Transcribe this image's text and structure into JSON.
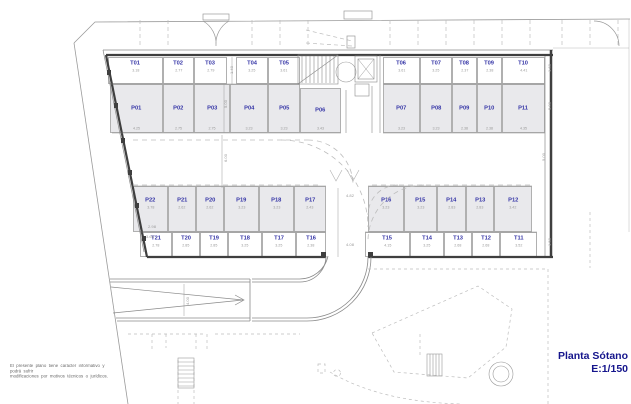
{
  "title": {
    "name": "Planta Sótano",
    "scale": "E:1/150"
  },
  "disclaimer": {
    "line1": "El presente plano tiene carácter informativo y podrá sufrir",
    "line2": "modificaciones por motivos técnicos o jurídicos."
  },
  "rows": {
    "top_trasteros_left": [
      {
        "id": "T01",
        "dim": "3.18"
      },
      {
        "id": "T02",
        "dim": "2.77"
      },
      {
        "id": "T03",
        "dim": "2.79"
      },
      {
        "id": "T04",
        "dim": "3.25"
      },
      {
        "id": "T05",
        "dim": "3.61"
      }
    ],
    "top_trasteros_right": [
      {
        "id": "T06",
        "dim": "3.61"
      },
      {
        "id": "T07",
        "dim": "3.25"
      },
      {
        "id": "T08",
        "dim": "2.37"
      },
      {
        "id": "T09",
        "dim": "2.38"
      },
      {
        "id": "T10",
        "dim": "4.41"
      }
    ],
    "top_parkings_left": [
      {
        "id": "P01",
        "dim": "4.25"
      },
      {
        "id": "P02",
        "dim": "2.75"
      },
      {
        "id": "P03",
        "dim": "2.75"
      },
      {
        "id": "P04",
        "dim": "3.23"
      },
      {
        "id": "P05",
        "dim": "3.23"
      }
    ],
    "center_parking": [
      {
        "id": "P06",
        "dim": "3.43"
      }
    ],
    "top_parkings_right": [
      {
        "id": "P07",
        "dim": "3.23"
      },
      {
        "id": "P08",
        "dim": "3.23"
      },
      {
        "id": "P09",
        "dim": "2.38"
      },
      {
        "id": "P10",
        "dim": "2.38"
      },
      {
        "id": "P11",
        "dim": "4.35"
      }
    ],
    "mid_parkings_left": [
      {
        "id": "P22",
        "dim": "3.78"
      },
      {
        "id": "P21",
        "dim": "2.62"
      },
      {
        "id": "P20",
        "dim": "2.62"
      },
      {
        "id": "P19",
        "dim": "3.23"
      },
      {
        "id": "P18",
        "dim": "3.23"
      },
      {
        "id": "P17",
        "dim": "2.43"
      }
    ],
    "mid_parkings_right": [
      {
        "id": "P16",
        "dim": "3.23"
      },
      {
        "id": "P15",
        "dim": "3.23"
      },
      {
        "id": "P14",
        "dim": "2.83"
      },
      {
        "id": "P13",
        "dim": "2.83"
      },
      {
        "id": "P12",
        "dim": "3.42"
      }
    ],
    "bottom_trasteros_left": [
      {
        "id": "T21",
        "dim": "2.78"
      },
      {
        "id": "T20",
        "dim": "2.85"
      },
      {
        "id": "T19",
        "dim": "2.85"
      },
      {
        "id": "T18",
        "dim": "3.25"
      },
      {
        "id": "T17",
        "dim": "3.25"
      },
      {
        "id": "T16",
        "dim": "2.38"
      }
    ],
    "bottom_trasteros_right": [
      {
        "id": "T15",
        "dim": "4.15"
      },
      {
        "id": "T14",
        "dim": "3.25"
      },
      {
        "id": "T13",
        "dim": "2.68"
      },
      {
        "id": "T12",
        "dim": "2.68"
      },
      {
        "id": "T11",
        "dim": "3.52"
      }
    ]
  },
  "dims": {
    "stall_depth": "5.00",
    "aisle_width": "6.00",
    "t03_strip": "1.40",
    "lane_upper": "4.82",
    "lane_lower": "4.08",
    "ramp_width": "4.00",
    "corner_a": "2.98",
    "corner_b": "3.68",
    "right_top": "1.60",
    "right_upper": "5.00",
    "right_mid": "5.00",
    "right_lower": "1.50"
  },
  "colors": {
    "unit_label": "#3434a6",
    "dim_label": "#9a9a9a",
    "title": "#15158c",
    "stall_fill": "#e9e9ec",
    "wall": "#3f3f3f"
  }
}
